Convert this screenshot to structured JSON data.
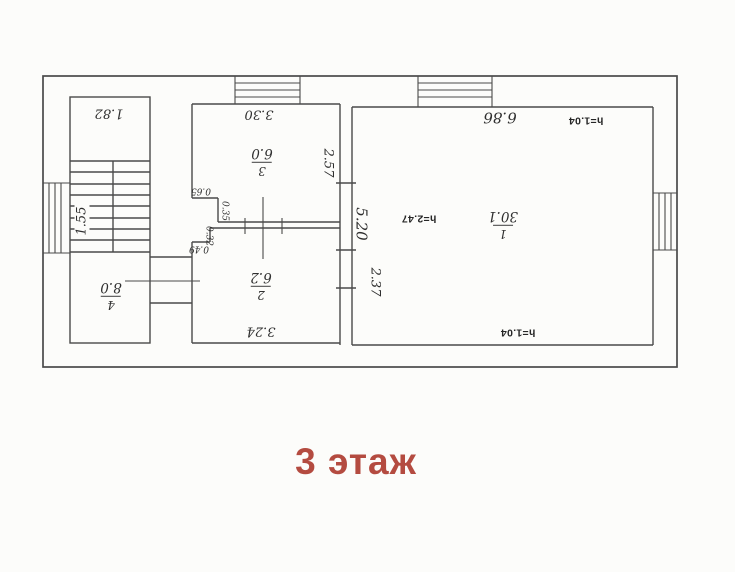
{
  "sheet": {
    "floor_title": "3 этаж",
    "title_color": "#b44b40",
    "ink_color": "#4a4a4a",
    "paper_color": "#fcfcfa"
  },
  "rooms": [
    {
      "number": "1",
      "area": "30.1"
    },
    {
      "number": "2",
      "area": "6.2"
    },
    {
      "number": "3",
      "area": "6.0"
    },
    {
      "number": "4",
      "area": "8.0"
    }
  ],
  "dimensions": {
    "stair_bay_width": "1.82",
    "stair_flight_length": "1.55",
    "room3_width": "3.30",
    "room3_depth": "2.57",
    "room1_width": "6.86",
    "room1_depth": "5.20",
    "room2_width": "3.24",
    "wall_segment": "2.37",
    "notch_width_a": "0.65",
    "notch_depth_a": "0.35",
    "notch_depth_b": "0.32",
    "notch_width_b": "0.49",
    "height_top": "h=1.04",
    "height_mid": "h=2.47",
    "height_bottom": "h=1.04"
  }
}
